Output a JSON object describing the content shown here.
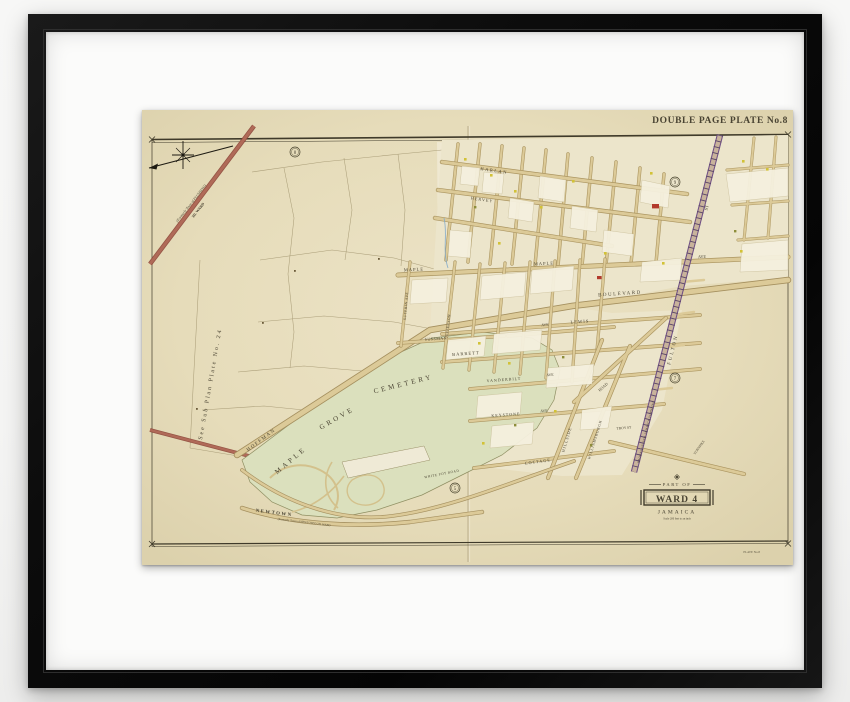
{
  "artwork": {
    "plate_title": "DOUBLE PAGE PLATE No.8",
    "corner_note": "PLATE No.8",
    "cartouche": {
      "part_of": "PART OF",
      "ward": "WARD 4",
      "place": "JAMAICA",
      "scale_note": "Scale 200 feet to an inch"
    },
    "boundaries": {
      "flushing_line1": "(Formerly Town of FLUSHING)",
      "flushing_line2": "3D. WARD",
      "newtown": "NEWTOWN",
      "newtown_sub": "(Formerly Town of NEWTOWN) 2D. WARD",
      "sub_plan_note": "See Sub Plan Plate No. 24"
    },
    "cemetery": {
      "word1": "MAPLE",
      "word2": "GROVE",
      "word3": "CEMETERY"
    },
    "plate_refs": {
      "top_left": "8",
      "top_right": "9",
      "right": "7",
      "bottom": "5"
    },
    "streets": {
      "harlan": "HARLAN",
      "hervey": "HERVEY",
      "maple_w": "MAPLE",
      "maple_e": "MAPLE",
      "maple_ave": "AVE",
      "boulevard": "BOULEVARD",
      "hoffman": "HOFFMAN",
      "sussman": "SUSSMAN",
      "lewis_ave": "AVE",
      "lewis": "LEWIS",
      "barrett": "BARRETT",
      "vanderbilt": "VANDERBILT",
      "vanderbilt_ave": "AVE",
      "keystone": "KEYSTONE",
      "keystone_ave": "AVE",
      "cottage": "COTTAGE",
      "hillside": "HILLSIDE",
      "williamsburgh": "WILLIAMSBURGH",
      "troy": "TROY ST",
      "road": "ROAD",
      "fulton": "FULTON",
      "fulton_st": "ST",
      "turnpike": "TURNPIKE",
      "brooklyn_jamaica": "BROOKLYN AND JAMAICA TURNPIKE",
      "sutphin": "SUTPHIN AVE",
      "jefferson": "JEFFERSON",
      "white_pot": "WHITE POT ROAD"
    },
    "colors": {
      "frame": "#0c0c0c",
      "mat": "#fbfbfa",
      "paper": "#e9e0c2",
      "cemetery_green": "#dbe0bd",
      "road_tan": "#dcca98",
      "boundary_road_red": "#a3584a",
      "railroad_purple": "#6f4f85",
      "ink": "#4a4433"
    }
  }
}
